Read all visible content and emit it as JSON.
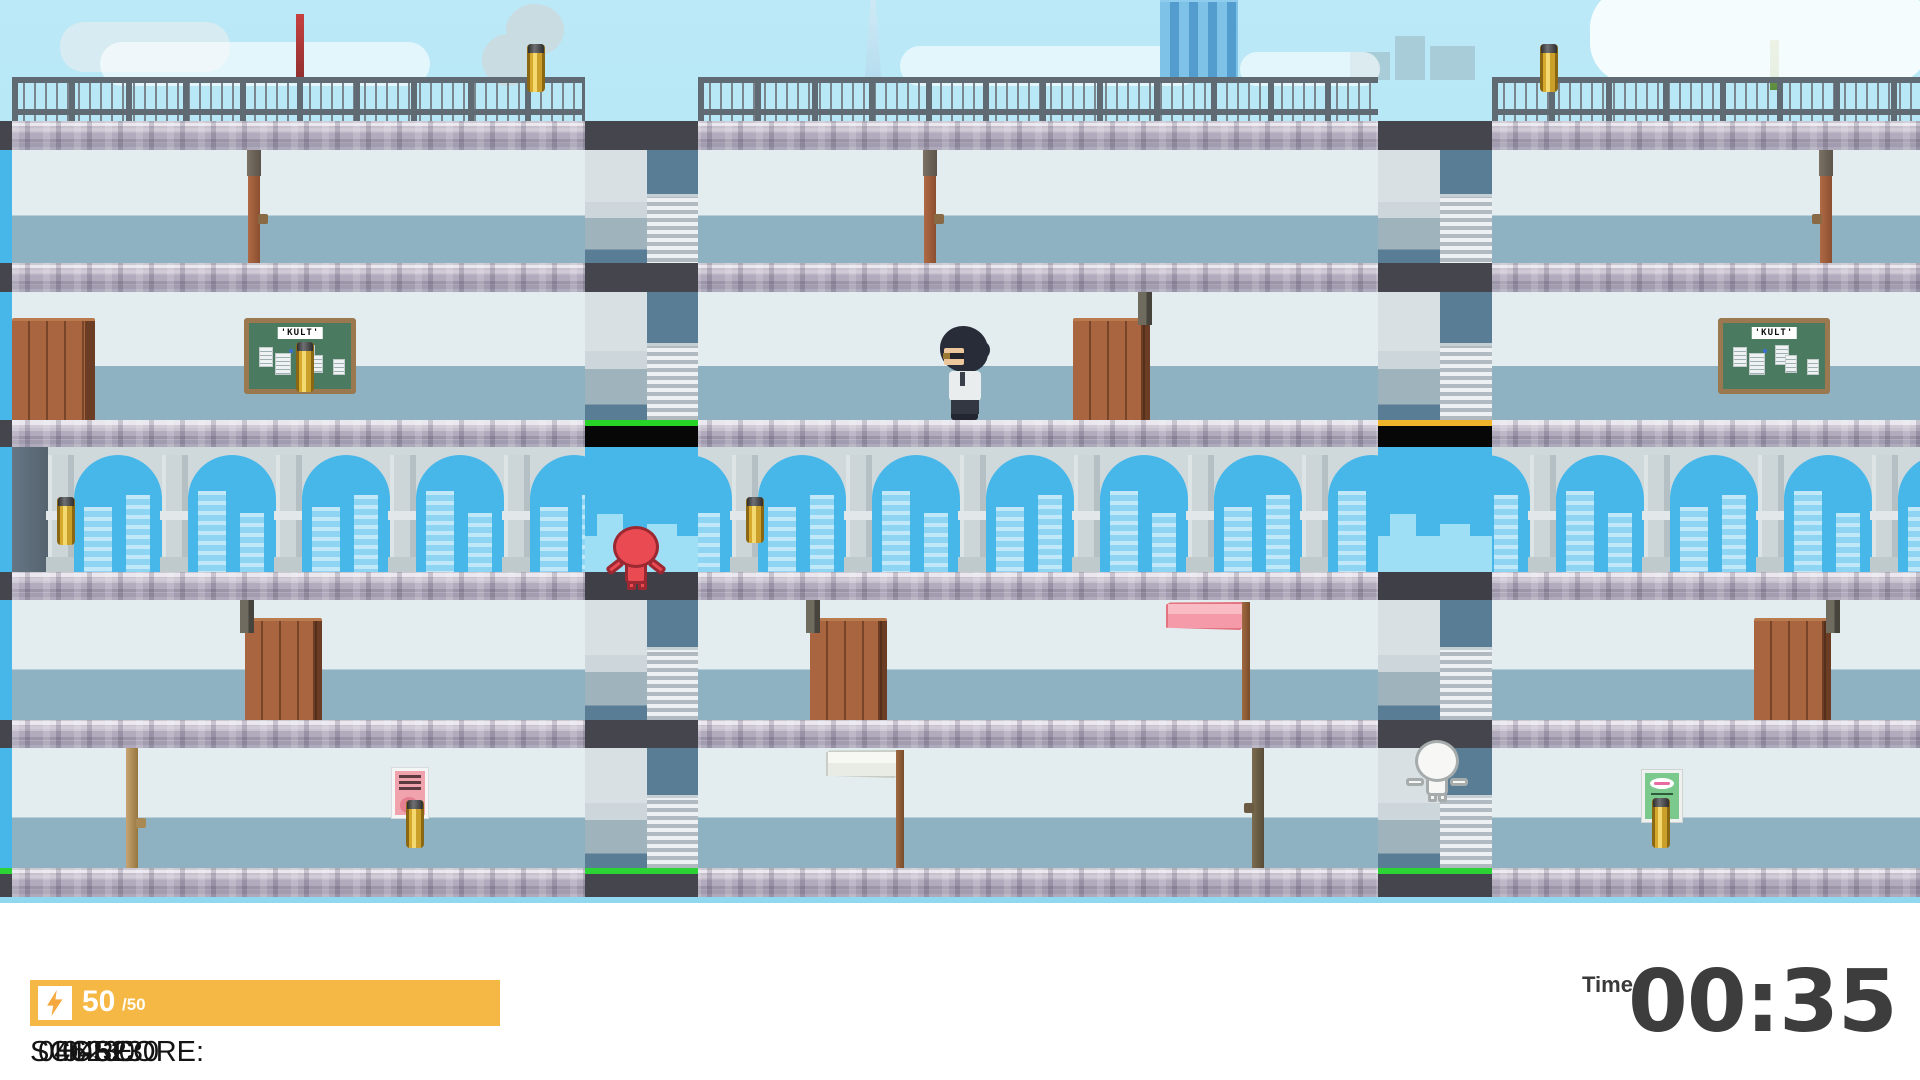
{
  "hud": {
    "energy": {
      "icon": "lightning-bolt-icon",
      "current": "50",
      "max": "/50"
    },
    "score_label": "SCORE:",
    "score_value": "046230",
    "hiscore_label": "HI-SCORE:",
    "hiscore_value": "046230",
    "time_label": "Time",
    "time_value": "00:35"
  },
  "boards": {
    "label": "'KULT'"
  },
  "colors": {
    "energy_bar": "#f6b844",
    "shaft1_indicator_line": "#27d327",
    "shaft2_indicator_line": "#f0b32c",
    "exit_line_green": "#2bd335",
    "arch_sky_blue": "#47b6e9",
    "capsule_gold": "#e8c23c",
    "stone_band": "#b2abbd"
  }
}
